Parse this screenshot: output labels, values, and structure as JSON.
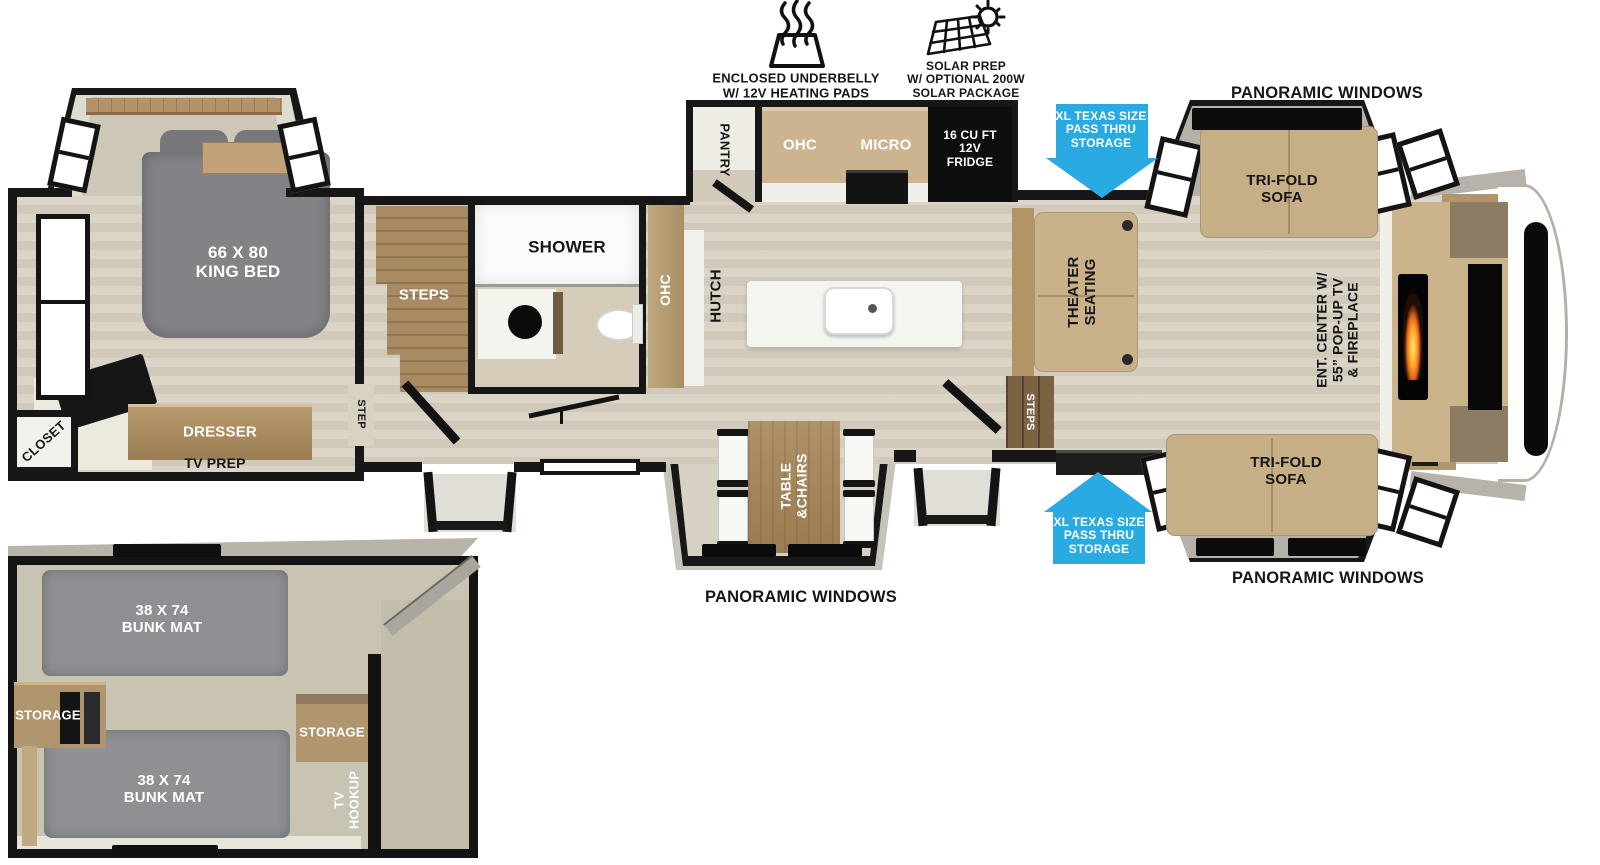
{
  "features": {
    "underbelly_line1": "ENCLOSED UNDERBELLY",
    "underbelly_line2": "W/ 12V HEATING PADS",
    "solar_line1": "SOLAR PREP",
    "solar_line2": "W/ OPTIONAL 200W",
    "solar_line3": "SOLAR PACKAGE"
  },
  "labels": {
    "panoramic": "PANORAMIC WINDOWS",
    "pass_thru_line1": "XL TEXAS SIZE",
    "pass_thru_line2": "PASS THRU",
    "pass_thru_line3": "STORAGE",
    "tri_fold_line1": "TRI-FOLD",
    "tri_fold_line2": "SOFA",
    "ent_center_line1": "ENT. CENTER W/",
    "ent_center_line2": "55” POP-UP TV",
    "ent_center_line3": "& FIREPLACE",
    "theater_line1": "THEATER",
    "theater_line2": "SEATING",
    "steps": "STEPS",
    "step": "STEP",
    "pantry": "PANTRY",
    "ohc": "OHC",
    "micro": "MICRO",
    "fridge_line1": "16 CU FT",
    "fridge_line2": "12V",
    "fridge_line3": "FRIDGE",
    "hutch": "HUTCH",
    "shower": "SHOWER",
    "table_line1": "TABLE",
    "table_line2": "&CHAIRS",
    "king_bed_line1": "66 X 80",
    "king_bed_line2": "KING BED",
    "dresser": "DRESSER",
    "tv_prep": "TV PREP",
    "closet": "CLOSET",
    "bunk_mat_line1": "38 X 74",
    "bunk_mat_line2": "BUNK MAT",
    "storage": "STORAGE",
    "tv_hookup_line1": "TV",
    "tv_hookup_line2": "HOOKUP"
  },
  "colors": {
    "arrow_blue": "#29abe2",
    "wall_black": "#171717",
    "floor_wood": "#d8d2c4",
    "sofa_tan": "#c6ae86",
    "cabinet_tan": "#ccb58e",
    "wood_brown": "#a8895e",
    "bed_gray": "#828287",
    "mat_gray": "#8f9094",
    "slide_wall": "#b5b1a7",
    "counter_white": "#f2f1ec"
  }
}
